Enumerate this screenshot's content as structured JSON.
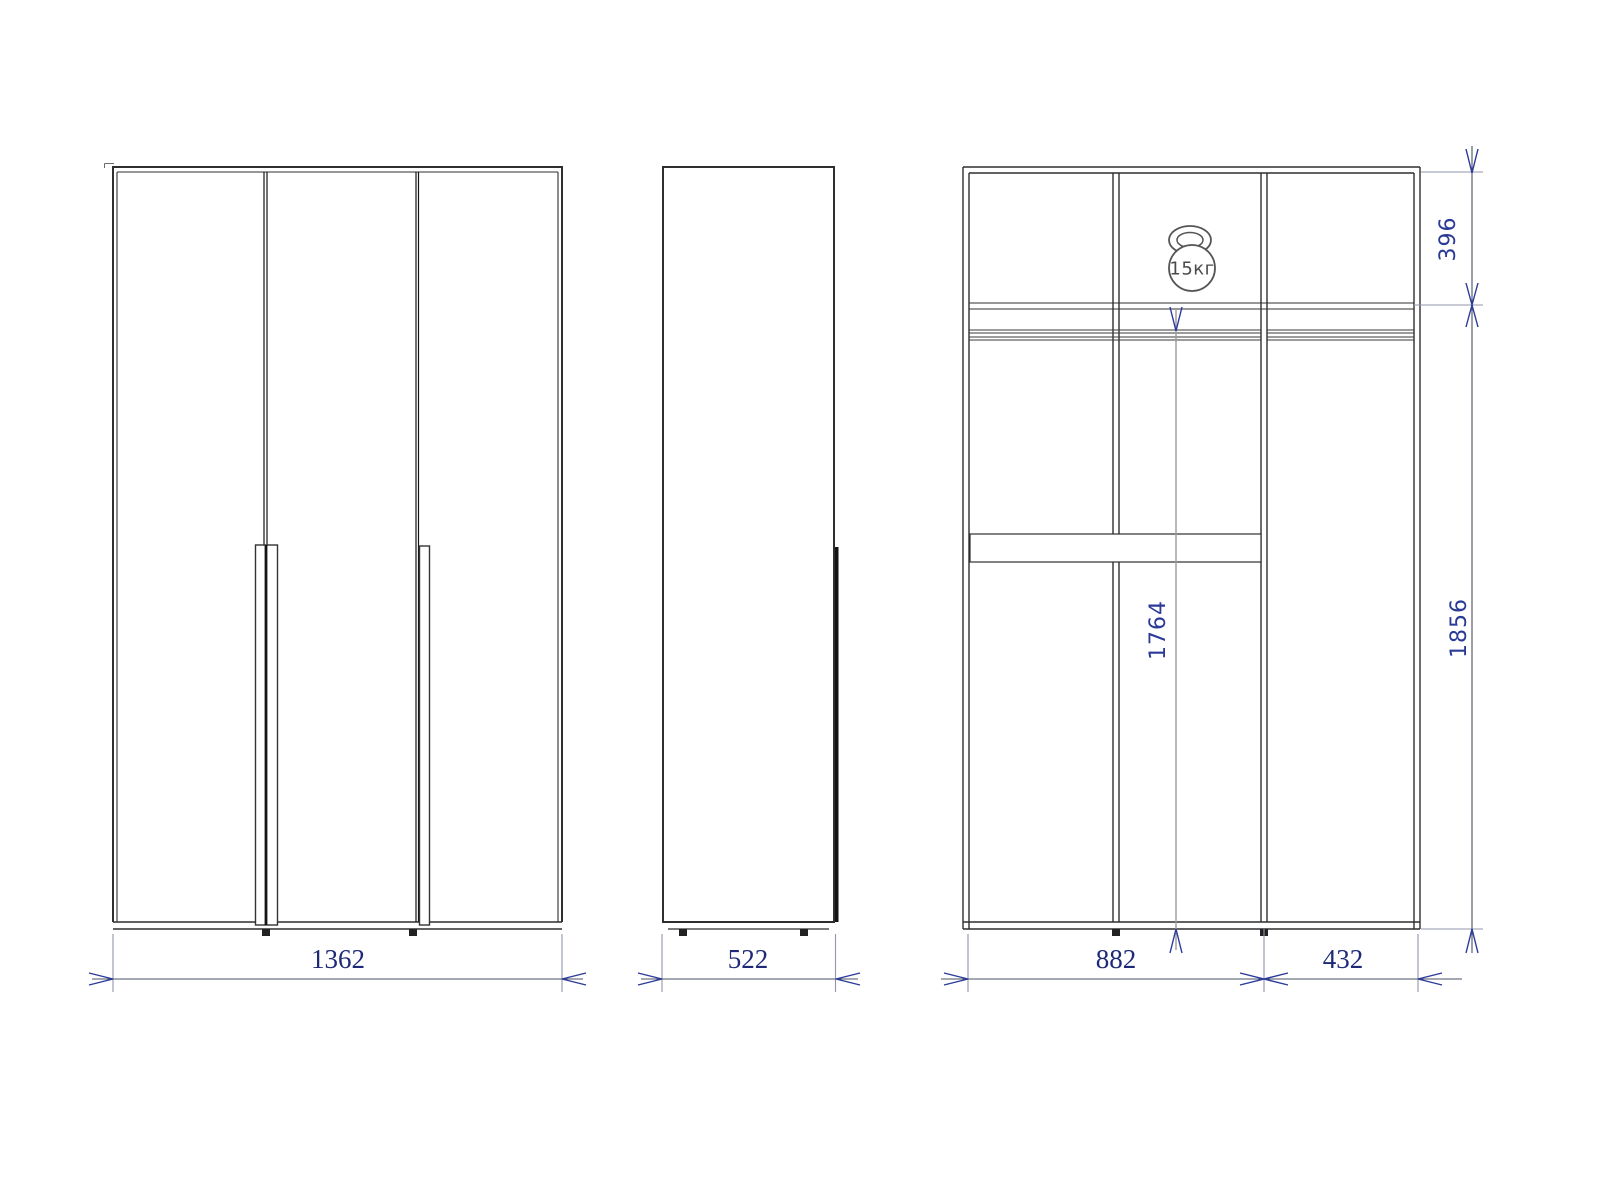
{
  "colors": {
    "object_line": "#2f2f2f",
    "dark_accent_line": "#141414",
    "dimension_line": "#4a5160",
    "extension_line": "#9097ad",
    "arrow": "#2b3a9a",
    "dimension_text": "#1e2a78",
    "rotated_dimension_text": "#2b3a96",
    "icon_outline": "#555555"
  },
  "front_view": {
    "overall_width": "1362"
  },
  "side_view": {
    "overall_depth": "522"
  },
  "section_view": {
    "left_bay_width": "882",
    "right_bay_width": "432",
    "top_compartment_height": "396",
    "interior_height": "1764",
    "body_height": "1856",
    "load_rating": "15кг"
  }
}
